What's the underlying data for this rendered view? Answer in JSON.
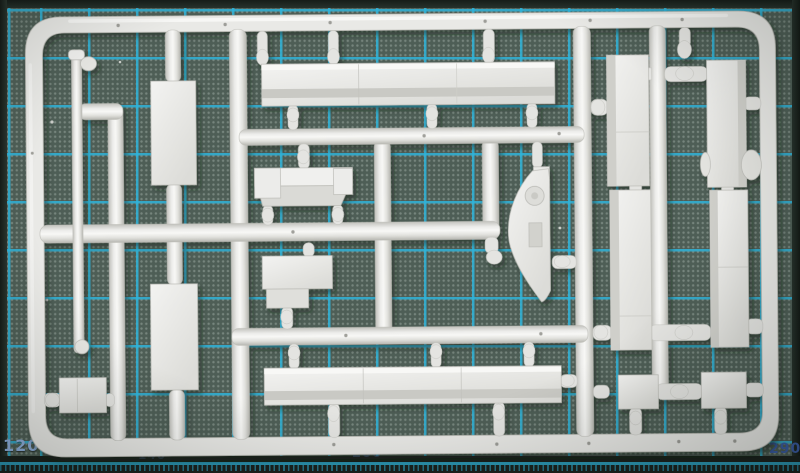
{
  "mat": {
    "ruler_labels": {
      "bottom_left": "120",
      "bottom_right": "290",
      "faint_center": "200",
      "faint_left": "140"
    },
    "colors": {
      "base": "#4e5e56",
      "grid_cyan": "#2fb4da",
      "edge_band": "#1c2420",
      "label_light_blue": "#8fb0dd",
      "label_dark_blue": "#3a5ca6"
    }
  },
  "sprue": {
    "plastic_color": "#e9e9e6",
    "parts": [
      "thin-rod",
      "flat-panel-upper",
      "flat-panel-lower",
      "long-plank-top",
      "bench-plank",
      "stepped-block",
      "dome-fin",
      "long-plank-bottom",
      "side-plank-left-upper",
      "side-plank-left-lower",
      "side-plank-right-upper",
      "side-plank-right-lower",
      "small-block-left",
      "small-block-right-a",
      "small-block-right-b"
    ]
  }
}
